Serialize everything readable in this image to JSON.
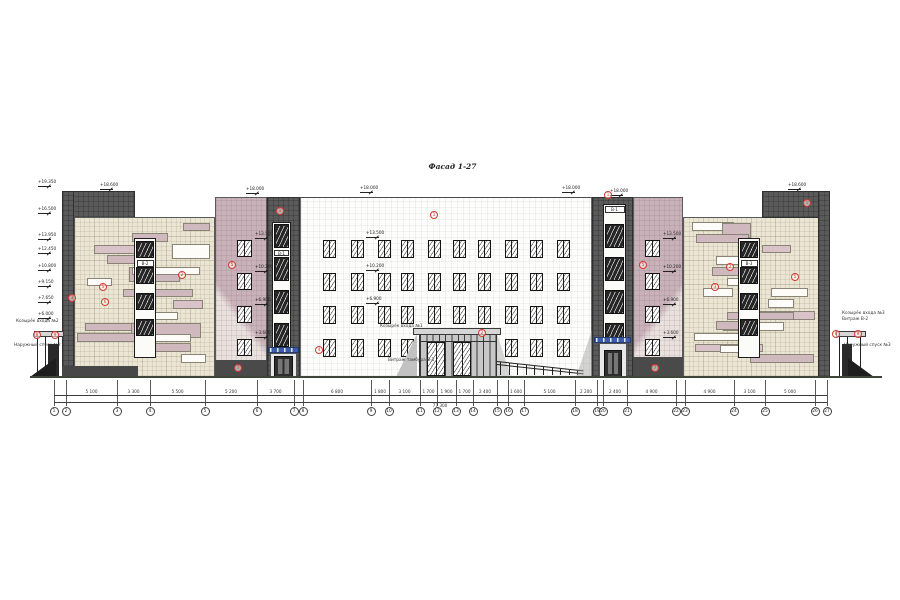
{
  "title": "Фасад 1-27",
  "colors": {
    "beige_wall": "#ebe6d4",
    "mauve_wall": "#c9b1ba",
    "dark_tile": "#5a5a5a",
    "white_wall": "#fdfdfc",
    "patch_white": "#fdfcf8",
    "patch_pink": "#d9c3c9",
    "patch_pink2": "#cfb9bf",
    "sign_blue": "#3b5ca8",
    "callout_red": "#d23b2f",
    "ground": "#3f4438"
  },
  "elevation_marks_left": [
    {
      "y": 184,
      "label": "+19.350"
    },
    {
      "y": 211,
      "label": "+16.500"
    },
    {
      "y": 237,
      "label": "+13.950"
    },
    {
      "y": 251,
      "label": "+12.450"
    },
    {
      "y": 268,
      "label": "+10.800"
    },
    {
      "y": 284,
      "label": "+9.150"
    },
    {
      "y": 300,
      "label": "+7.650"
    },
    {
      "y": 316,
      "label": "+6.000"
    }
  ],
  "roof_marks": [
    {
      "x": 100,
      "y": 187,
      "label": "+18.600"
    },
    {
      "x": 246,
      "y": 191,
      "label": "+18.000"
    },
    {
      "x": 360,
      "y": 190,
      "label": "+18.000"
    },
    {
      "x": 562,
      "y": 190,
      "label": "+18.000"
    },
    {
      "x": 610,
      "y": 193,
      "label": "+18.000"
    },
    {
      "x": 788,
      "y": 187,
      "label": "+18.600"
    }
  ],
  "row_marks_left": [
    {
      "y": 236,
      "label": "+13.500"
    },
    {
      "y": 269,
      "label": "+10.200"
    },
    {
      "y": 302,
      "label": "+6.900"
    },
    {
      "y": 335,
      "label": "+3.600"
    }
  ],
  "row_marks_right": [
    {
      "y": 236,
      "label": "+13.500"
    },
    {
      "y": 269,
      "label": "+10.200"
    },
    {
      "y": 302,
      "label": "+6.900"
    },
    {
      "y": 335,
      "label": "+3.600"
    }
  ],
  "central_row_marks": [
    {
      "x": 366,
      "y": 235,
      "label": "+13.500"
    },
    {
      "x": 366,
      "y": 268,
      "label": "+10.200"
    },
    {
      "x": 366,
      "y": 301,
      "label": "+6.900"
    }
  ],
  "strip_labels": {
    "left_wing": "В-2",
    "right_wing": "В-3",
    "tower_right": "В-1",
    "tower_left": "В-1"
  },
  "annotations": [
    {
      "x": 16,
      "y": 320,
      "text": "Козырёк входа №2"
    },
    {
      "x": 14,
      "y": 344,
      "text": "Наружный спуск №2"
    },
    {
      "x": 380,
      "y": 325,
      "text": "Козырёк входа №1"
    },
    {
      "x": 388,
      "y": 359,
      "text": "Витраж тамбура В-1"
    },
    {
      "x": 842,
      "y": 312,
      "text": "Козырёк входа №3"
    },
    {
      "x": 842,
      "y": 318,
      "text": "Витраж В-2"
    },
    {
      "x": 844,
      "y": 344,
      "text": "Наружный спуск №3"
    }
  ],
  "callouts": [
    {
      "x": 72,
      "y": 298,
      "n": "3"
    },
    {
      "x": 103,
      "y": 287,
      "n": "5"
    },
    {
      "x": 105,
      "y": 302,
      "n": "6"
    },
    {
      "x": 182,
      "y": 275,
      "n": "2"
    },
    {
      "x": 232,
      "y": 265,
      "n": "5"
    },
    {
      "x": 280,
      "y": 211,
      "n": "1"
    },
    {
      "x": 238,
      "y": 368,
      "n": "7"
    },
    {
      "x": 37,
      "y": 335,
      "n": "8"
    },
    {
      "x": 55,
      "y": 335,
      "n": "9"
    },
    {
      "x": 319,
      "y": 350,
      "n": "4"
    },
    {
      "x": 434,
      "y": 215,
      "n": "1"
    },
    {
      "x": 482,
      "y": 333,
      "n": "2"
    },
    {
      "x": 608,
      "y": 195,
      "n": "1"
    },
    {
      "x": 643,
      "y": 265,
      "n": "5"
    },
    {
      "x": 715,
      "y": 287,
      "n": "3"
    },
    {
      "x": 730,
      "y": 267,
      "n": "2"
    },
    {
      "x": 795,
      "y": 277,
      "n": "5"
    },
    {
      "x": 807,
      "y": 203,
      "n": "1"
    },
    {
      "x": 655,
      "y": 368,
      "n": "7"
    },
    {
      "x": 836,
      "y": 334,
      "n": "8"
    },
    {
      "x": 858,
      "y": 334,
      "n": "9"
    }
  ],
  "axes": [
    {
      "n": "1",
      "x": 54
    },
    {
      "n": "2",
      "x": 66
    },
    {
      "n": "3",
      "x": 117
    },
    {
      "n": "4",
      "x": 150
    },
    {
      "n": "5",
      "x": 205
    },
    {
      "n": "6",
      "x": 257
    },
    {
      "n": "7",
      "x": 294
    },
    {
      "n": "8",
      "x": 303
    },
    {
      "n": "9",
      "x": 371
    },
    {
      "n": "10",
      "x": 389
    },
    {
      "n": "11",
      "x": 420
    },
    {
      "n": "12",
      "x": 437
    },
    {
      "n": "13",
      "x": 456
    },
    {
      "n": "14",
      "x": 473
    },
    {
      "n": "15",
      "x": 497
    },
    {
      "n": "16",
      "x": 508
    },
    {
      "n": "17",
      "x": 524
    },
    {
      "n": "18",
      "x": 575
    },
    {
      "n": "19",
      "x": 597
    },
    {
      "n": "20",
      "x": 603
    },
    {
      "n": "21",
      "x": 627
    },
    {
      "n": "22",
      "x": 676
    },
    {
      "n": "23",
      "x": 685
    },
    {
      "n": "24",
      "x": 734
    },
    {
      "n": "25",
      "x": 765
    },
    {
      "n": "26",
      "x": 815
    },
    {
      "n": "27",
      "x": 827
    }
  ],
  "dims": [
    {
      "x1": 66,
      "x2": 117,
      "label": "5 100"
    },
    {
      "x1": 117,
      "x2": 150,
      "label": "3 300"
    },
    {
      "x1": 150,
      "x2": 205,
      "label": "5 500"
    },
    {
      "x1": 205,
      "x2": 257,
      "label": "5 200"
    },
    {
      "x1": 257,
      "x2": 294,
      "label": "3 700"
    },
    {
      "x1": 303,
      "x2": 371,
      "label": "6 800"
    },
    {
      "x1": 371,
      "x2": 389,
      "label": "1 800"
    },
    {
      "x1": 389,
      "x2": 420,
      "label": "3 100"
    },
    {
      "x1": 420,
      "x2": 437,
      "label": "1 700"
    },
    {
      "x1": 437,
      "x2": 456,
      "label": "1 900"
    },
    {
      "x1": 456,
      "x2": 473,
      "label": "1 700"
    },
    {
      "x1": 473,
      "x2": 497,
      "label": "2 400"
    },
    {
      "x1": 508,
      "x2": 524,
      "label": "1 600"
    },
    {
      "x1": 524,
      "x2": 575,
      "label": "5 100"
    },
    {
      "x1": 575,
      "x2": 597,
      "label": "2 200"
    },
    {
      "x1": 603,
      "x2": 627,
      "label": "2 400"
    },
    {
      "x1": 627,
      "x2": 676,
      "label": "4 900"
    },
    {
      "x1": 685,
      "x2": 734,
      "label": "4 900"
    },
    {
      "x1": 734,
      "x2": 765,
      "label": "3 100"
    },
    {
      "x1": 765,
      "x2": 815,
      "label": "5 000"
    }
  ],
  "total_dim": "77 300"
}
